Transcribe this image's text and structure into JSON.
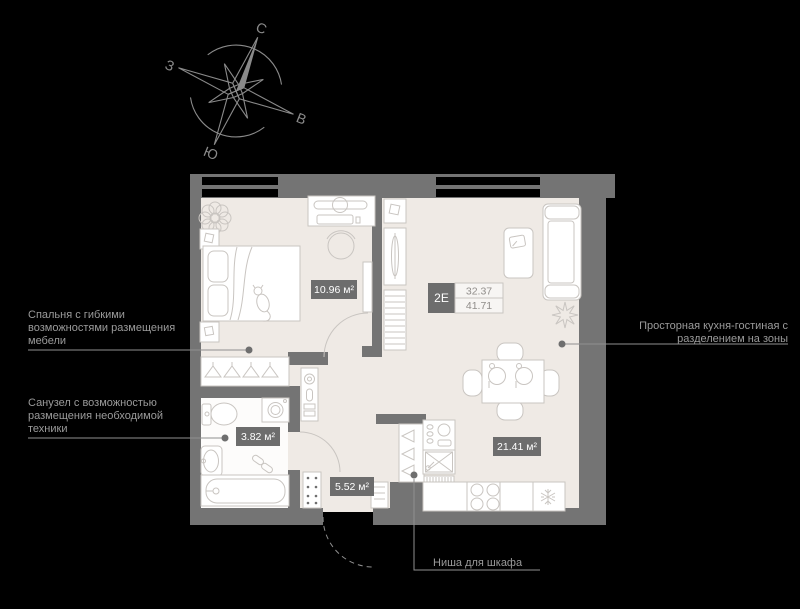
{
  "colors": {
    "background": "#000000",
    "wall": "#747474",
    "floor": "#efeae5",
    "furniture_line": "#c9c5c1",
    "window": "#000000",
    "badge_bg": "#6d6d6d",
    "badge_text": "#ffffff",
    "text": "#9b9b9b",
    "leader": "#8f8f8f",
    "leader_dot": "#6e6e6e",
    "compass": "#8a8a8a"
  },
  "compass": {
    "north": "С",
    "east": "В",
    "south": "Ю",
    "west": "З"
  },
  "unit": {
    "code": "2Е",
    "area_top": "32.37",
    "area_bottom": "41.71"
  },
  "rooms": {
    "bedroom": {
      "area": "10.96 м²"
    },
    "bathroom": {
      "area": "3.82 м²"
    },
    "hallway": {
      "area": "5.52 м²"
    },
    "kitchen_living": {
      "area": "21.41 м²"
    }
  },
  "annotations": {
    "bedroom": {
      "line1": "Спальня с гибкими",
      "line2": "возможностями размещения",
      "line3": "мебели"
    },
    "bathroom": {
      "line1": "Санузел с возможностью",
      "line2": "размещения необходимой",
      "line3": "техники"
    },
    "kitchen": {
      "line1": "Просторная кухня-гостиная с",
      "line2": "разделением на зоны"
    },
    "wardrobe_niche": {
      "line1": "Ниша для шкафа"
    }
  }
}
